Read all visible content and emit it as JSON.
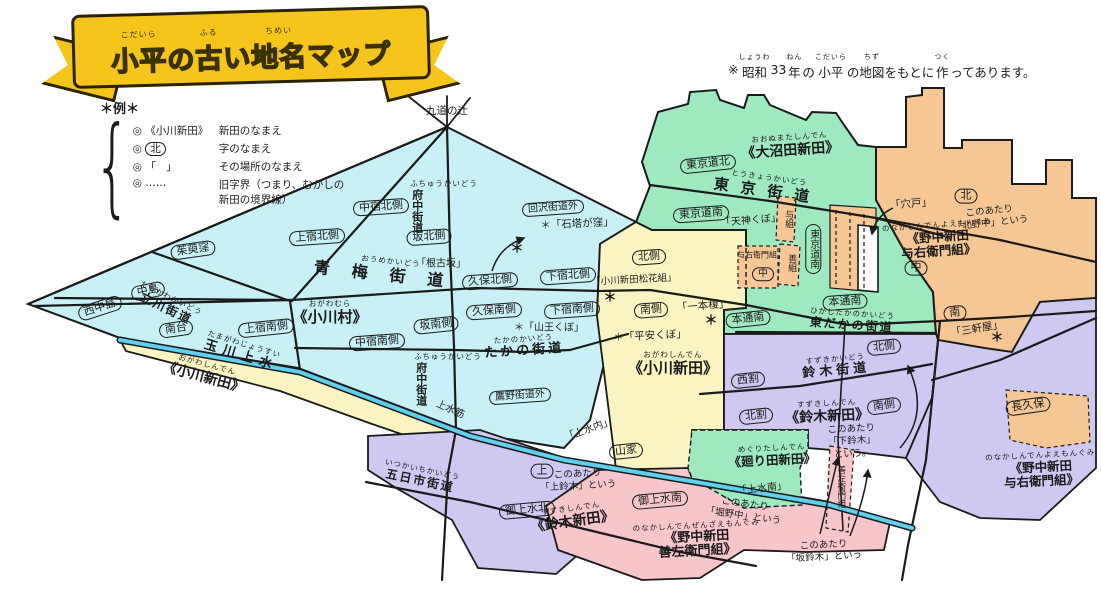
{
  "title": {
    "segments": [
      {
        "t": "小平",
        "r": "こだいら"
      },
      {
        "t": "の"
      },
      {
        "t": "古",
        "r": "ふる"
      },
      {
        "t": "い"
      },
      {
        "t": "地名",
        "r": "ちめい"
      },
      {
        "t": "マップ"
      }
    ]
  },
  "note": {
    "segments": [
      {
        "t": "※"
      },
      {
        "t": "昭和",
        "r": "しょうわ"
      },
      {
        "t": "33"
      },
      {
        "t": "年",
        "r": "ねん"
      },
      {
        "t": "の"
      },
      {
        "t": "小平",
        "r": "こだいら"
      },
      {
        "t": "の"
      },
      {
        "t": "地図",
        "r": "ちず"
      },
      {
        "t": "をもとに"
      },
      {
        "t": "作",
        "r": "つく"
      },
      {
        "t": "ってあります。"
      }
    ]
  },
  "legend": {
    "heading": "＊例＊",
    "heading_reading": "れい",
    "items": [
      {
        "prefix": "◎",
        "symbol": "《小川新田》",
        "oval": false,
        "desc": "新田のなまえ",
        "reading": "しんでん"
      },
      {
        "prefix": "◎",
        "symbol": "北",
        "oval": true,
        "desc": "字のなまえ",
        "reading": "あざ"
      },
      {
        "prefix": "◎",
        "symbol": "「　」",
        "oval": false,
        "desc": "その場所のなまえ",
        "reading": "ばしょ"
      },
      {
        "prefix": "◎",
        "symbol": "……",
        "oval": false,
        "desc": "旧字界（つまり、むかしの\n新田の境界線）",
        "reading": "きゅうあざかい・しんでんのきょうかいせん"
      }
    ]
  },
  "palette": {
    "banner": "#f6c51c",
    "cyan": "#c8f0f6",
    "yellow": "#faf3c2",
    "green": "#9fe9c0",
    "orange": "#f6c794",
    "purple": "#cfc8f0",
    "pink": "#f6c6ca",
    "canal": "#5fd0ee",
    "ink": "#1b1b1b"
  },
  "map": {
    "labels": [
      {
        "s": "quote",
        "t": "九道の辻",
        "r": "くどうのつじ",
        "x": 447,
        "y": 111,
        "rot": 0,
        "fs": 10.5
      },
      {
        "s": "oval",
        "t": "西中島",
        "r": "にしなかじま",
        "x": 100,
        "y": 308,
        "rot": -18
      },
      {
        "s": "oval",
        "t": "中島",
        "r": "なかじま",
        "x": 148,
        "y": 291,
        "rot": -12
      },
      {
        "s": "road",
        "t": "立川街道",
        "r": "たちかわかいどう",
        "x": 168,
        "y": 305,
        "rot": 26,
        "fs": 12,
        "ls": 2
      },
      {
        "s": "oval",
        "t": "南台",
        "r": "みなみだい",
        "x": 176,
        "y": 329,
        "rot": -8
      },
      {
        "s": "oval",
        "t": "茱萸窪",
        "r": "ぐみくぼ",
        "x": 193,
        "y": 250,
        "rot": -8
      },
      {
        "s": "oval",
        "t": "上宿南側",
        "r": "かみじゅくみなみがわ",
        "x": 266,
        "y": 328,
        "rot": -6
      },
      {
        "s": "oval",
        "t": "中宿北側",
        "r": "なかじゅくきたがわ",
        "x": 381,
        "y": 207,
        "rot": -4
      },
      {
        "s": "oval",
        "t": "上宿北側",
        "r": "かみじゅくきたがわ",
        "x": 317,
        "y": 237,
        "rot": -4
      },
      {
        "s": "oval",
        "t": "坂北側",
        "r": "さかきたがわ",
        "x": 429,
        "y": 237,
        "rot": -4
      },
      {
        "s": "quote",
        "t": "「根古坂」",
        "r": "ねっこざか",
        "x": 441,
        "y": 264,
        "rot": 0,
        "fs": 10
      },
      {
        "s": "road",
        "t": "青梅街道",
        "r": "おうめかいどう",
        "x": 390,
        "y": 271,
        "rot": 6,
        "fs": 16,
        "ls": 22
      },
      {
        "s": "big",
        "t": "《小川村》",
        "r": "おがわむら",
        "x": 330,
        "y": 313,
        "rot": 0,
        "fs": 15
      },
      {
        "s": "oval",
        "t": "中宿南側",
        "r": "なかじゅくみなみがわ",
        "x": 377,
        "y": 342,
        "rot": -4
      },
      {
        "s": "oval",
        "t": "坂南側",
        "r": "さかみなみがわ",
        "x": 436,
        "y": 325,
        "rot": -6
      },
      {
        "s": "road-v",
        "t": "府中街道",
        "r": "ふちゅうかいどう",
        "x": 444,
        "y": 206,
        "rot": 0,
        "fs": 11
      },
      {
        "s": "oval",
        "t": "回沢街道外",
        "r": "めぐりさわかいどうそと",
        "x": 553,
        "y": 208,
        "rot": -4,
        "fs": 10
      },
      {
        "s": "quote",
        "t": "＊「石塔が窪」",
        "r": "せきとうがくぼ",
        "x": 577,
        "y": 224,
        "rot": -3,
        "fs": 10.5
      },
      {
        "s": "oval",
        "t": "久保北側",
        "r": "くぼきたがわ",
        "x": 490,
        "y": 281,
        "rot": -4
      },
      {
        "s": "oval",
        "t": "下宿北側",
        "r": "しもじゅくきたがわ",
        "x": 568,
        "y": 276,
        "rot": -4
      },
      {
        "s": "oval",
        "t": "久保南側",
        "r": "くぼみなみがわ",
        "x": 494,
        "y": 311,
        "rot": -4
      },
      {
        "s": "oval",
        "t": "下宿南側",
        "r": "しもじゅくみなみがわ",
        "x": 572,
        "y": 310,
        "rot": -4
      },
      {
        "s": "quote",
        "t": "＊「山王くぼ」",
        "r": "さんのうくぼ",
        "x": 549,
        "y": 328,
        "rot": 0,
        "fs": 10
      },
      {
        "s": "road",
        "t": "たかの街道",
        "r": "たかのかいどう",
        "x": 524,
        "y": 347,
        "rot": -4,
        "fs": 13,
        "ls": 3
      },
      {
        "s": "road-v",
        "t": "府中街道",
        "r": "ふちゅうかいどう",
        "x": 448,
        "y": 379,
        "rot": 0,
        "fs": 11
      },
      {
        "s": "oval",
        "t": "鷹野街道外",
        "r": "たかのかいどうそと",
        "x": 520,
        "y": 396,
        "rot": -4,
        "fs": 10
      },
      {
        "s": "road",
        "t": "玉川上水",
        "r": "たまがわじょうすい",
        "x": 242,
        "y": 352,
        "rot": 17,
        "fs": 13,
        "ls": 6
      },
      {
        "s": "big",
        "t": "《小川新田》",
        "r": "おがわしんでん",
        "x": 205,
        "y": 373,
        "rot": 15,
        "fs": 14
      },
      {
        "s": "plain",
        "t": "上水筋",
        "r": "",
        "x": 450,
        "y": 410,
        "rot": 24,
        "fs": 10
      },
      {
        "s": "road",
        "t": "五日市街道",
        "r": "いつかいちかいどう",
        "x": 421,
        "y": 477,
        "rot": 12,
        "fs": 12,
        "ls": 2
      },
      {
        "s": "oval",
        "t": "北側",
        "r": "きたがわ",
        "x": 649,
        "y": 257,
        "rot": -4
      },
      {
        "s": "quote",
        "t": "「小川新田松花組」",
        "r": "",
        "x": 634,
        "y": 281,
        "rot": -3,
        "fs": 9.5
      },
      {
        "s": "oval",
        "t": "南側",
        "r": "みなみがわ",
        "x": 651,
        "y": 310,
        "rot": -4
      },
      {
        "s": "quote",
        "t": "「一本榎」",
        "r": "いっぽんえのき",
        "x": 703,
        "y": 306,
        "rot": -5,
        "fs": 10.5
      },
      {
        "s": "quote",
        "t": "＊「平安くぼ」",
        "r": "へいあんくぼ",
        "x": 650,
        "y": 336,
        "rot": -3,
        "fs": 10.5
      },
      {
        "s": "big",
        "t": "《小川新田》",
        "r": "おがわしんでん",
        "x": 673,
        "y": 364,
        "rot": 0,
        "fs": 15
      },
      {
        "s": "quote",
        "t": "「上水内」",
        "r": "じょうすいうち",
        "x": 589,
        "y": 430,
        "rot": -20,
        "fs": 10
      },
      {
        "s": "oval",
        "t": "山家",
        "r": "さんや",
        "x": 626,
        "y": 451,
        "rot": -6
      },
      {
        "s": "big",
        "t": "《大沼田新田》",
        "r": "おおぬまたしんでん",
        "x": 790,
        "y": 146,
        "rot": -4,
        "fs": 14
      },
      {
        "s": "oval",
        "t": "東京道北",
        "r": "とうきょうみちきた",
        "x": 708,
        "y": 164,
        "rot": -6
      },
      {
        "s": "road",
        "t": "東京街道",
        "r": "とうきょうかいどう",
        "x": 768,
        "y": 187,
        "rot": 8,
        "fs": 15,
        "ls": 12
      },
      {
        "s": "oval",
        "t": "東京道南",
        "r": "とうきょうみちみなみ",
        "x": 701,
        "y": 214,
        "rot": -4
      },
      {
        "s": "quote",
        "t": "「天神くぼ」",
        "r": "てんじんくぼ",
        "x": 751,
        "y": 221,
        "rot": -5,
        "fs": 10
      },
      {
        "s": "plain-v",
        "t": "与組",
        "r": "",
        "x": 788,
        "y": 219,
        "rot": 0,
        "fs": 9
      },
      {
        "s": "plain",
        "t": "与右衛門組",
        "r": "",
        "x": 757,
        "y": 255,
        "rot": 0,
        "fs": 8
      },
      {
        "s": "oval",
        "t": "中",
        "r": "なか",
        "x": 763,
        "y": 274,
        "rot": 0,
        "fs": 10
      },
      {
        "s": "plain-v",
        "t": "善組",
        "r": "",
        "x": 791,
        "y": 263,
        "rot": 0,
        "fs": 9
      },
      {
        "s": "oval-v",
        "t": "東京道南",
        "r": "とうきょうみちみなみ",
        "x": 813,
        "y": 249,
        "rot": 0,
        "fs": 10
      },
      {
        "s": "oval",
        "t": "本通南",
        "r": "ほんどおりみなみ",
        "x": 748,
        "y": 319,
        "rot": -6
      },
      {
        "s": "oval",
        "t": "本通南",
        "r": "ほんどおりみなみ",
        "x": 845,
        "y": 302,
        "rot": -4
      },
      {
        "s": "road",
        "t": "東だかの街道",
        "r": "ひがしたかのかいどう",
        "x": 852,
        "y": 321,
        "rot": 4,
        "fs": 12,
        "ls": 2
      },
      {
        "s": "oval",
        "t": "北側",
        "r": "きたがわ",
        "x": 884,
        "y": 347,
        "rot": -6
      },
      {
        "s": "road",
        "t": "鈴木街道",
        "r": "すずきかいどう",
        "x": 836,
        "y": 367,
        "rot": -5,
        "fs": 13,
        "ls": 4
      },
      {
        "s": "big",
        "t": "《鈴木新田》",
        "r": "すずきしんでん",
        "x": 827,
        "y": 412,
        "rot": -3,
        "fs": 14
      },
      {
        "s": "oval",
        "t": "南側",
        "r": "みなみがわ",
        "x": 884,
        "y": 406,
        "rot": -8
      },
      {
        "s": "note",
        "t": "このあたり\n「下鈴木」\nという。",
        "r": "しもすずき",
        "x": 852,
        "y": 442,
        "rot": -3,
        "fs": 9.5
      },
      {
        "s": "oval",
        "t": "西割",
        "r": "にしわり",
        "x": 748,
        "y": 380,
        "rot": -6
      },
      {
        "s": "oval",
        "t": "北割",
        "r": "きたわり",
        "x": 756,
        "y": 416,
        "rot": -6
      },
      {
        "s": "big",
        "t": "《廻り田新田》",
        "r": "めぐりたしんでん",
        "x": 772,
        "y": 456,
        "rot": -3,
        "fs": 12.5
      },
      {
        "s": "quote",
        "t": "「上水南」",
        "r": "じょうすいみなみ",
        "x": 762,
        "y": 489,
        "rot": -6,
        "fs": 10
      },
      {
        "s": "oval",
        "t": "上",
        "r": "かみ",
        "x": 542,
        "y": 471,
        "rot": 0
      },
      {
        "s": "note",
        "t": "このあたり\n「上鈴木」という",
        "r": "かみすずき",
        "x": 578,
        "y": 481,
        "rot": -3,
        "fs": 9.5
      },
      {
        "s": "big",
        "t": "《鈴木新田》",
        "r": "すずきしんでん",
        "x": 572,
        "y": 517,
        "rot": -8,
        "fs": 14
      },
      {
        "s": "oval",
        "t": "御上水南",
        "r": "ごじょうすいみなみ",
        "x": 660,
        "y": 500,
        "rot": -5
      },
      {
        "s": "oval",
        "t": "御上水北",
        "r": "ごじょうすいきた",
        "x": 527,
        "y": 510,
        "rot": -5
      },
      {
        "s": "note",
        "t": "このあたり\n「堀野中」という",
        "r": "ほりのなか",
        "x": 744,
        "y": 511,
        "rot": 8,
        "fs": 9.5
      },
      {
        "s": "big",
        "t": "《野中新田\n善左衛門組》",
        "r": "のなかしんでんぜんざえもんぐみ",
        "x": 697,
        "y": 541,
        "rot": -3,
        "fs": 13
      },
      {
        "s": "plain-v",
        "t": "善左衛門組",
        "r": "",
        "x": 840,
        "y": 487,
        "rot": 0,
        "fs": 8.5
      },
      {
        "s": "note",
        "t": "このあたり\n「坂鈴木」という",
        "r": "さかすずき",
        "x": 824,
        "y": 552,
        "rot": -3,
        "fs": 9.5
      },
      {
        "s": "oval",
        "t": "南",
        "r": "みなみ",
        "x": 955,
        "y": 313,
        "rot": -6
      },
      {
        "s": "quote",
        "t": "「三軒屋」",
        "r": "さんげんや",
        "x": 977,
        "y": 329,
        "rot": -10,
        "fs": 10.5
      },
      {
        "s": "oval",
        "t": "長久保",
        "r": "ながくぼ",
        "x": 1028,
        "y": 406,
        "rot": -8
      },
      {
        "s": "big",
        "t": "《野中新田\n与右衛門組》",
        "r": "のなかしんでんよえもんぐみ",
        "x": 1041,
        "y": 470,
        "rot": -3,
        "fs": 12.5
      },
      {
        "s": "oval",
        "t": "北",
        "r": "きた",
        "x": 966,
        "y": 196,
        "rot": 0
      },
      {
        "s": "quote",
        "t": "「穴戸」",
        "r": "",
        "x": 911,
        "y": 204,
        "rot": -5,
        "fs": 10.5
      },
      {
        "s": "note",
        "t": "このあたり\n「北野中」という",
        "r": "きたのなか",
        "x": 990,
        "y": 218,
        "rot": -6,
        "fs": 9.5
      },
      {
        "s": "big",
        "t": "《野中新田\n与右衛門組》",
        "r": "のなかしんでんよえもんぐみ",
        "x": 938,
        "y": 240,
        "rot": -4,
        "fs": 12.5
      },
      {
        "s": "oval",
        "t": "中",
        "r": "なか",
        "x": 916,
        "y": 268,
        "rot": 0
      },
      {
        "s": "star",
        "t": "＊",
        "r": "",
        "x": 517,
        "y": 250,
        "rot": 0,
        "fs": 13
      },
      {
        "s": "star",
        "t": "＊",
        "r": "",
        "x": 610,
        "y": 299,
        "rot": 0,
        "fs": 13
      },
      {
        "s": "star",
        "t": "＊",
        "r": "",
        "x": 711,
        "y": 322,
        "rot": 0,
        "fs": 13
      },
      {
        "s": "star",
        "t": "＊",
        "r": "",
        "x": 997,
        "y": 339,
        "rot": 0,
        "fs": 13
      }
    ]
  }
}
